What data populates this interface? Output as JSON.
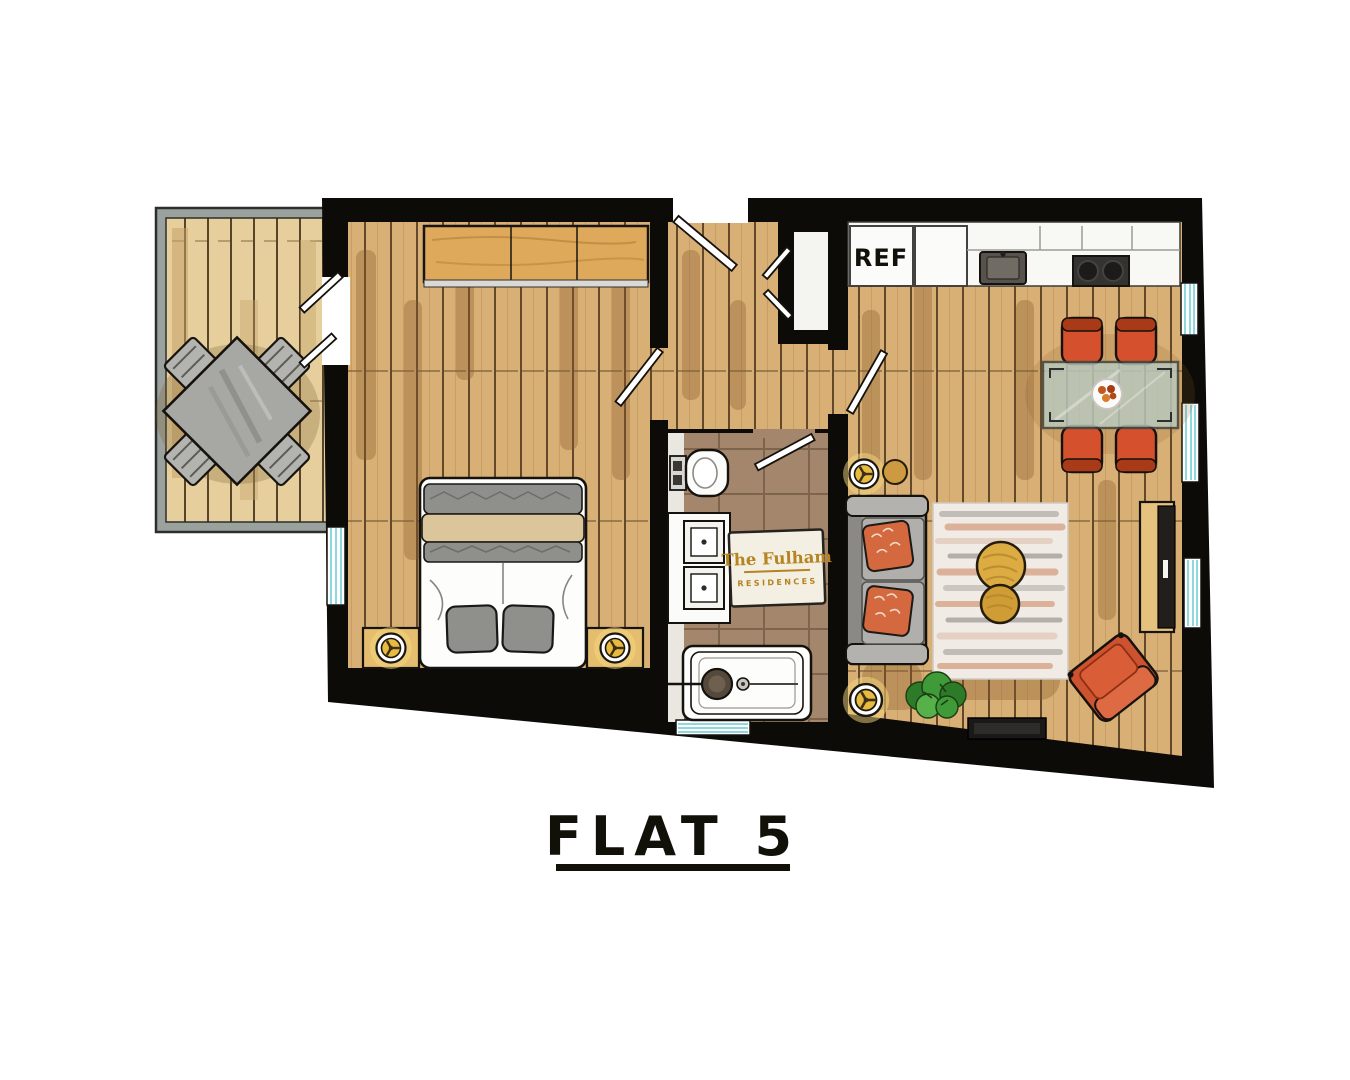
{
  "title": "FLAT 5",
  "plaque": {
    "line1": "The Fulham",
    "line2": "RESIDENCES"
  },
  "kitchen": {
    "fridge_label": "REF"
  },
  "palette": {
    "wall": "#0d0b08",
    "wood_floor": "#d8af75",
    "deck_wood": "#e6cf9d",
    "bath_tile": "#a3866b",
    "chair_red": "#d5512d",
    "sofa_gray": "#9c9b97",
    "gold": "#dcab42",
    "window_glass": "#8fd8de",
    "plaque_text": "#b5831f"
  }
}
